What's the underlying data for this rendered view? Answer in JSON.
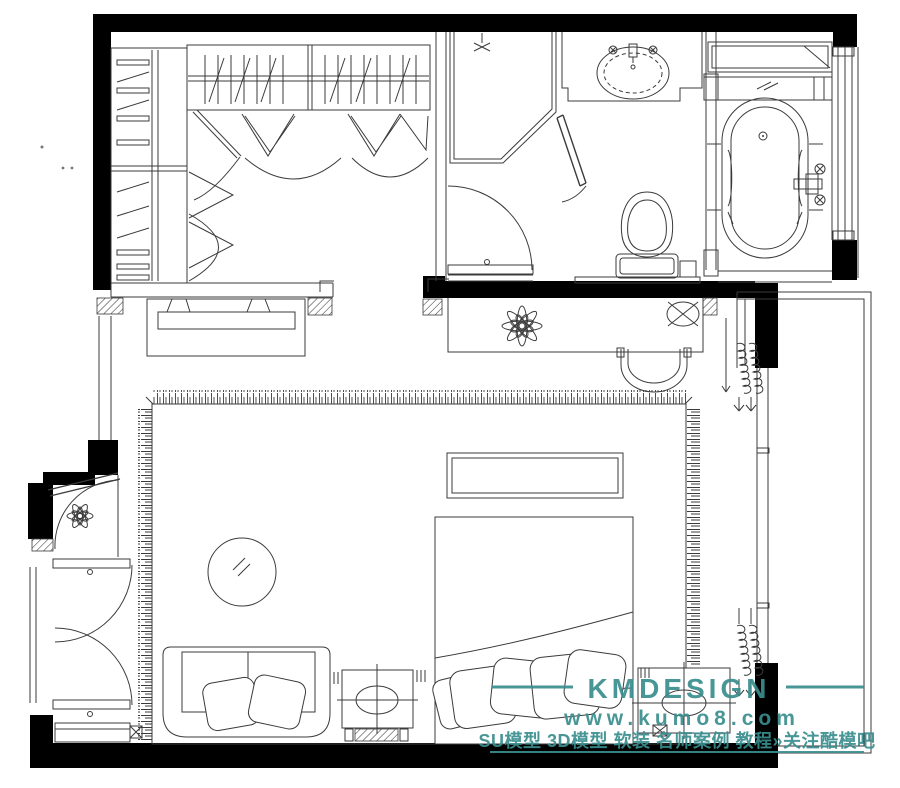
{
  "title": "bedroom-suite-floor-plan",
  "colors": {
    "background": "#ffffff",
    "wall": "#000000",
    "line": "#3b3b3b",
    "watermark": "#3a8e8f"
  },
  "watermark": {
    "brand": "KMDESIGN",
    "url": "www.kumo8.com",
    "tagline": "SU模型 3D模型 软装 名师案例 教程»关注酷模吧"
  },
  "floorplan": {
    "rooms": [
      "walk-in-closet",
      "bathroom",
      "bathtub-room",
      "bedroom",
      "balcony"
    ],
    "icons": [
      "wardrobe-icon",
      "hanger-rail-icon",
      "bifold-door-icon",
      "shower-icon",
      "shower-head-icon",
      "wash-basin-icon",
      "faucet-icon",
      "toilet-icon",
      "bathtub-icon",
      "tub-faucet-icon",
      "mirror-shelf-icon",
      "window-icon",
      "tv-cabinet-icon",
      "tv-icon",
      "dressing-desk-icon",
      "potted-plant-icon",
      "desk-lamp-icon",
      "chair-icon",
      "rug-icon",
      "double-bed-icon",
      "pillow-icon",
      "bed-bench-icon",
      "nightstand-icon",
      "table-lamp-icon",
      "sofa-icon",
      "throw-pillow-icon",
      "side-table-icon",
      "ottoman-icon",
      "low-cabinet-icon",
      "entry-door-icon",
      "swing-door-icon",
      "curtain-icon",
      "balcony-icon"
    ]
  }
}
